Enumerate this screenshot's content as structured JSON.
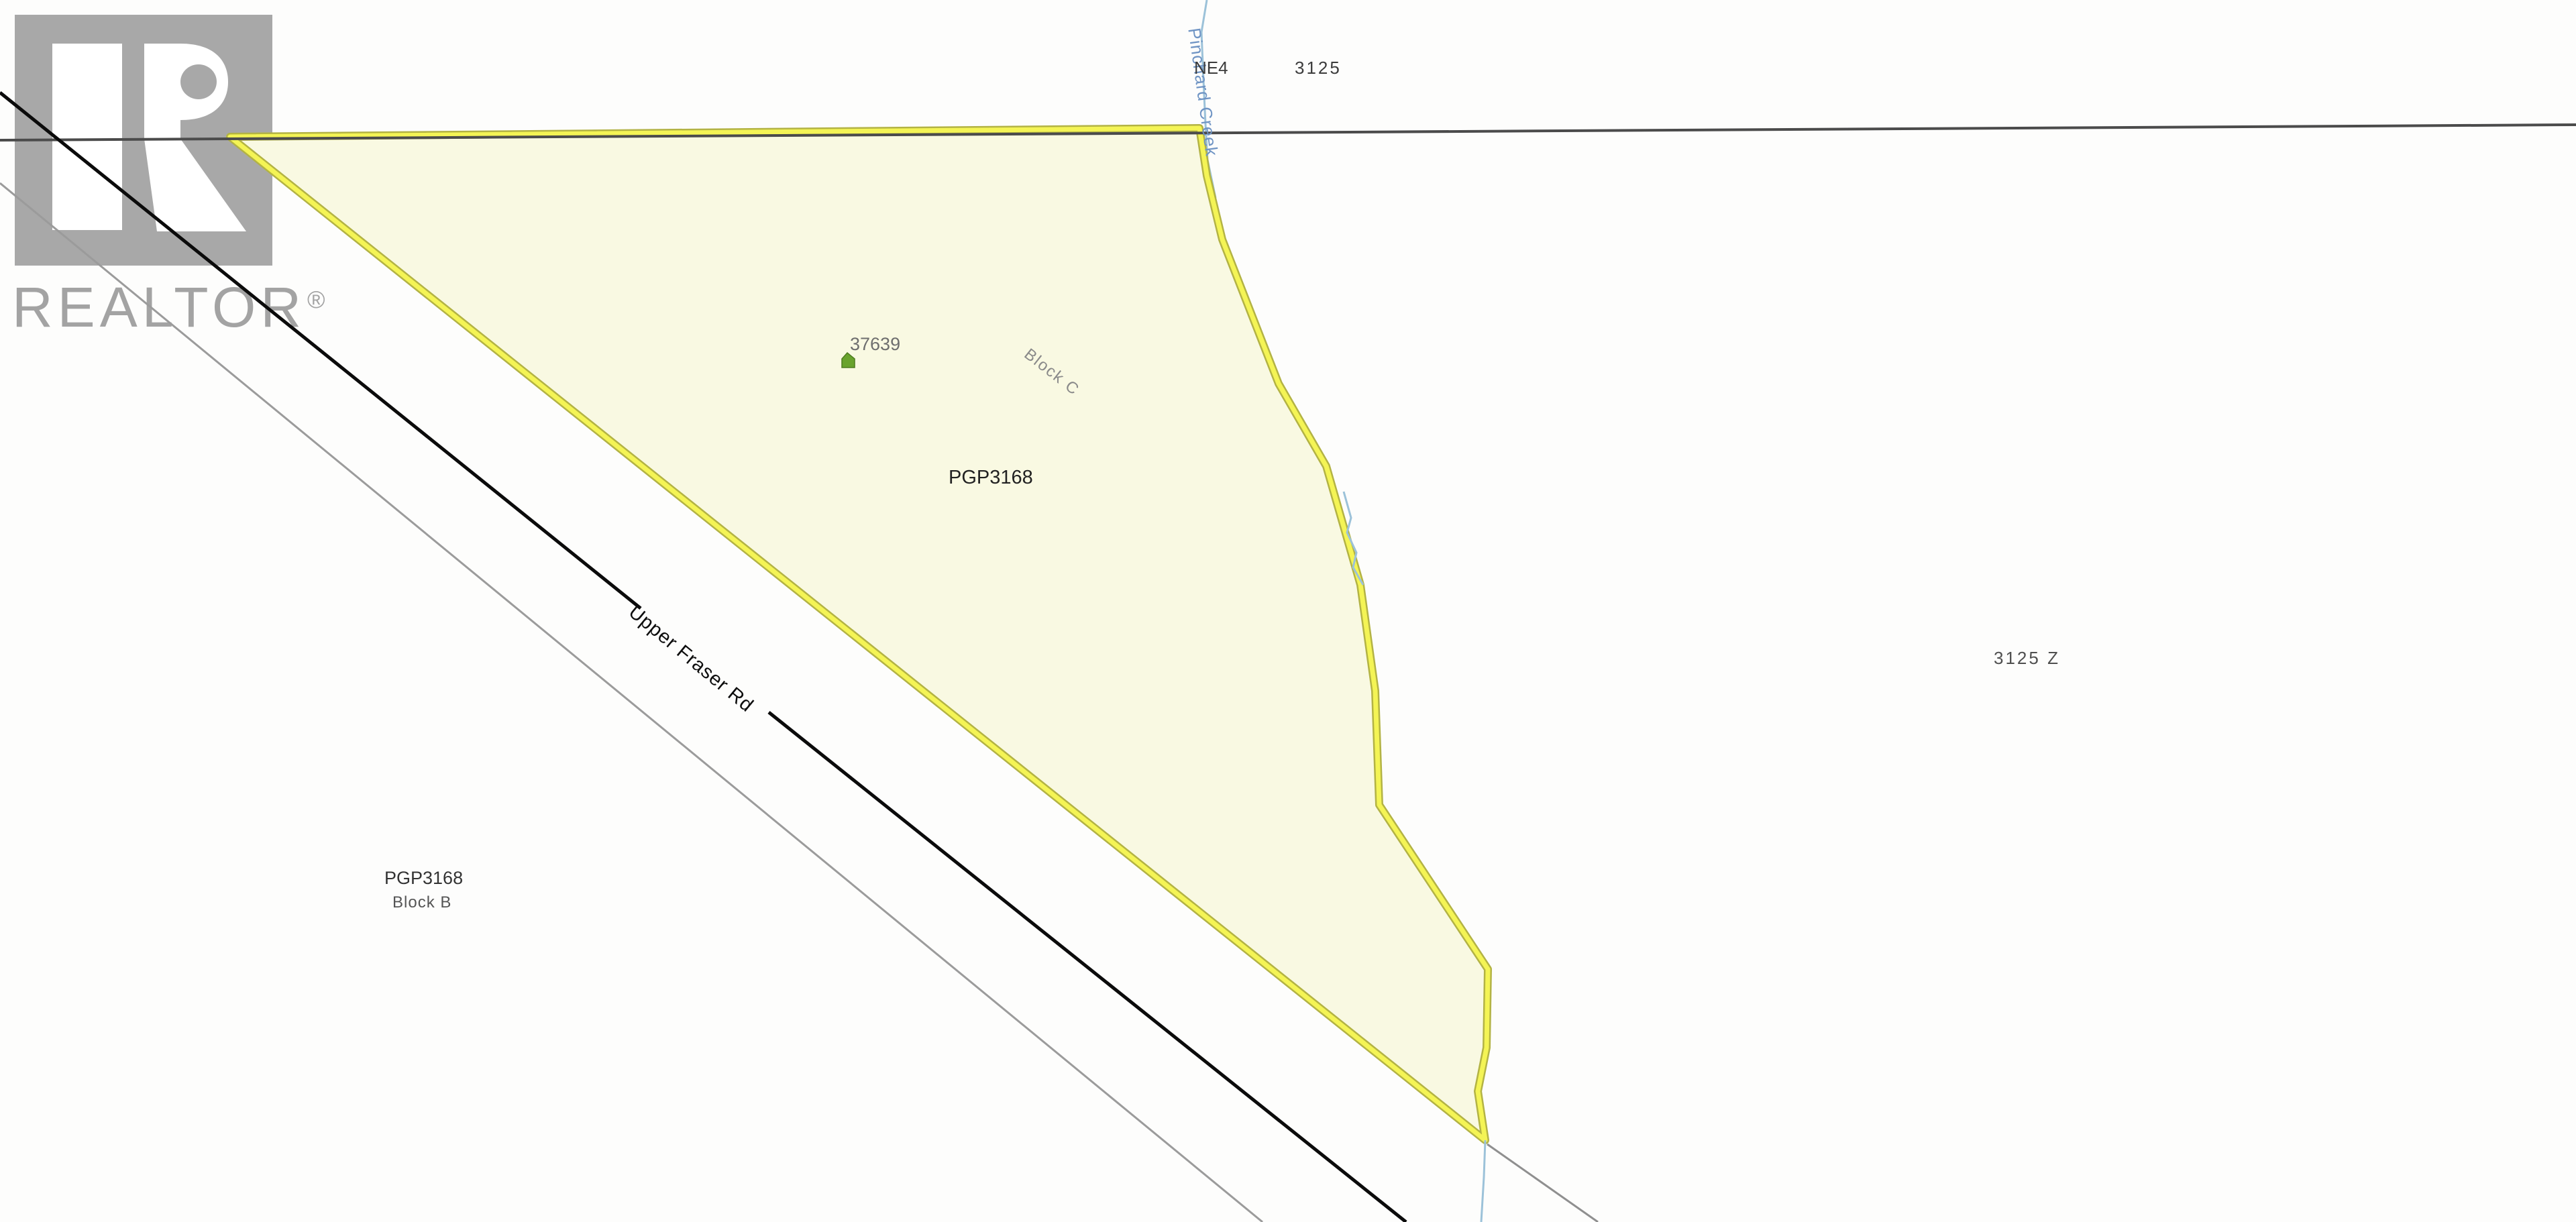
{
  "watermark": {
    "brand": "REALTOR",
    "registered_mark": "®"
  },
  "map": {
    "labels": {
      "quarter_section": "NE4",
      "section_top": "3125",
      "section_right": "3125 Z",
      "parcel_pin": "37639",
      "block_c": "Block C",
      "plan_number_center": "PGP3168",
      "plan_number_bottom": "PGP3168",
      "block_b": "Block B",
      "road_name": "Upper Fraser Rd",
      "creek_name": "Pinchard Creek"
    },
    "icons": {
      "house": "house-icon"
    },
    "colors": {
      "parcel_fill": "#f9f9e2",
      "parcel_highlight": "#f4f455",
      "parcel_casing": "#b3b344",
      "section_line": "#4b4b4b",
      "road_primary": "#0b0b0b",
      "road_secondary": "#9b9b9b",
      "lot_line": "#8f8f8f",
      "creek": "#9cc2d9",
      "creek_label": "#6f94c4",
      "house_icon": "#69a32d",
      "watermark_gray": "#a8a8a8"
    }
  }
}
